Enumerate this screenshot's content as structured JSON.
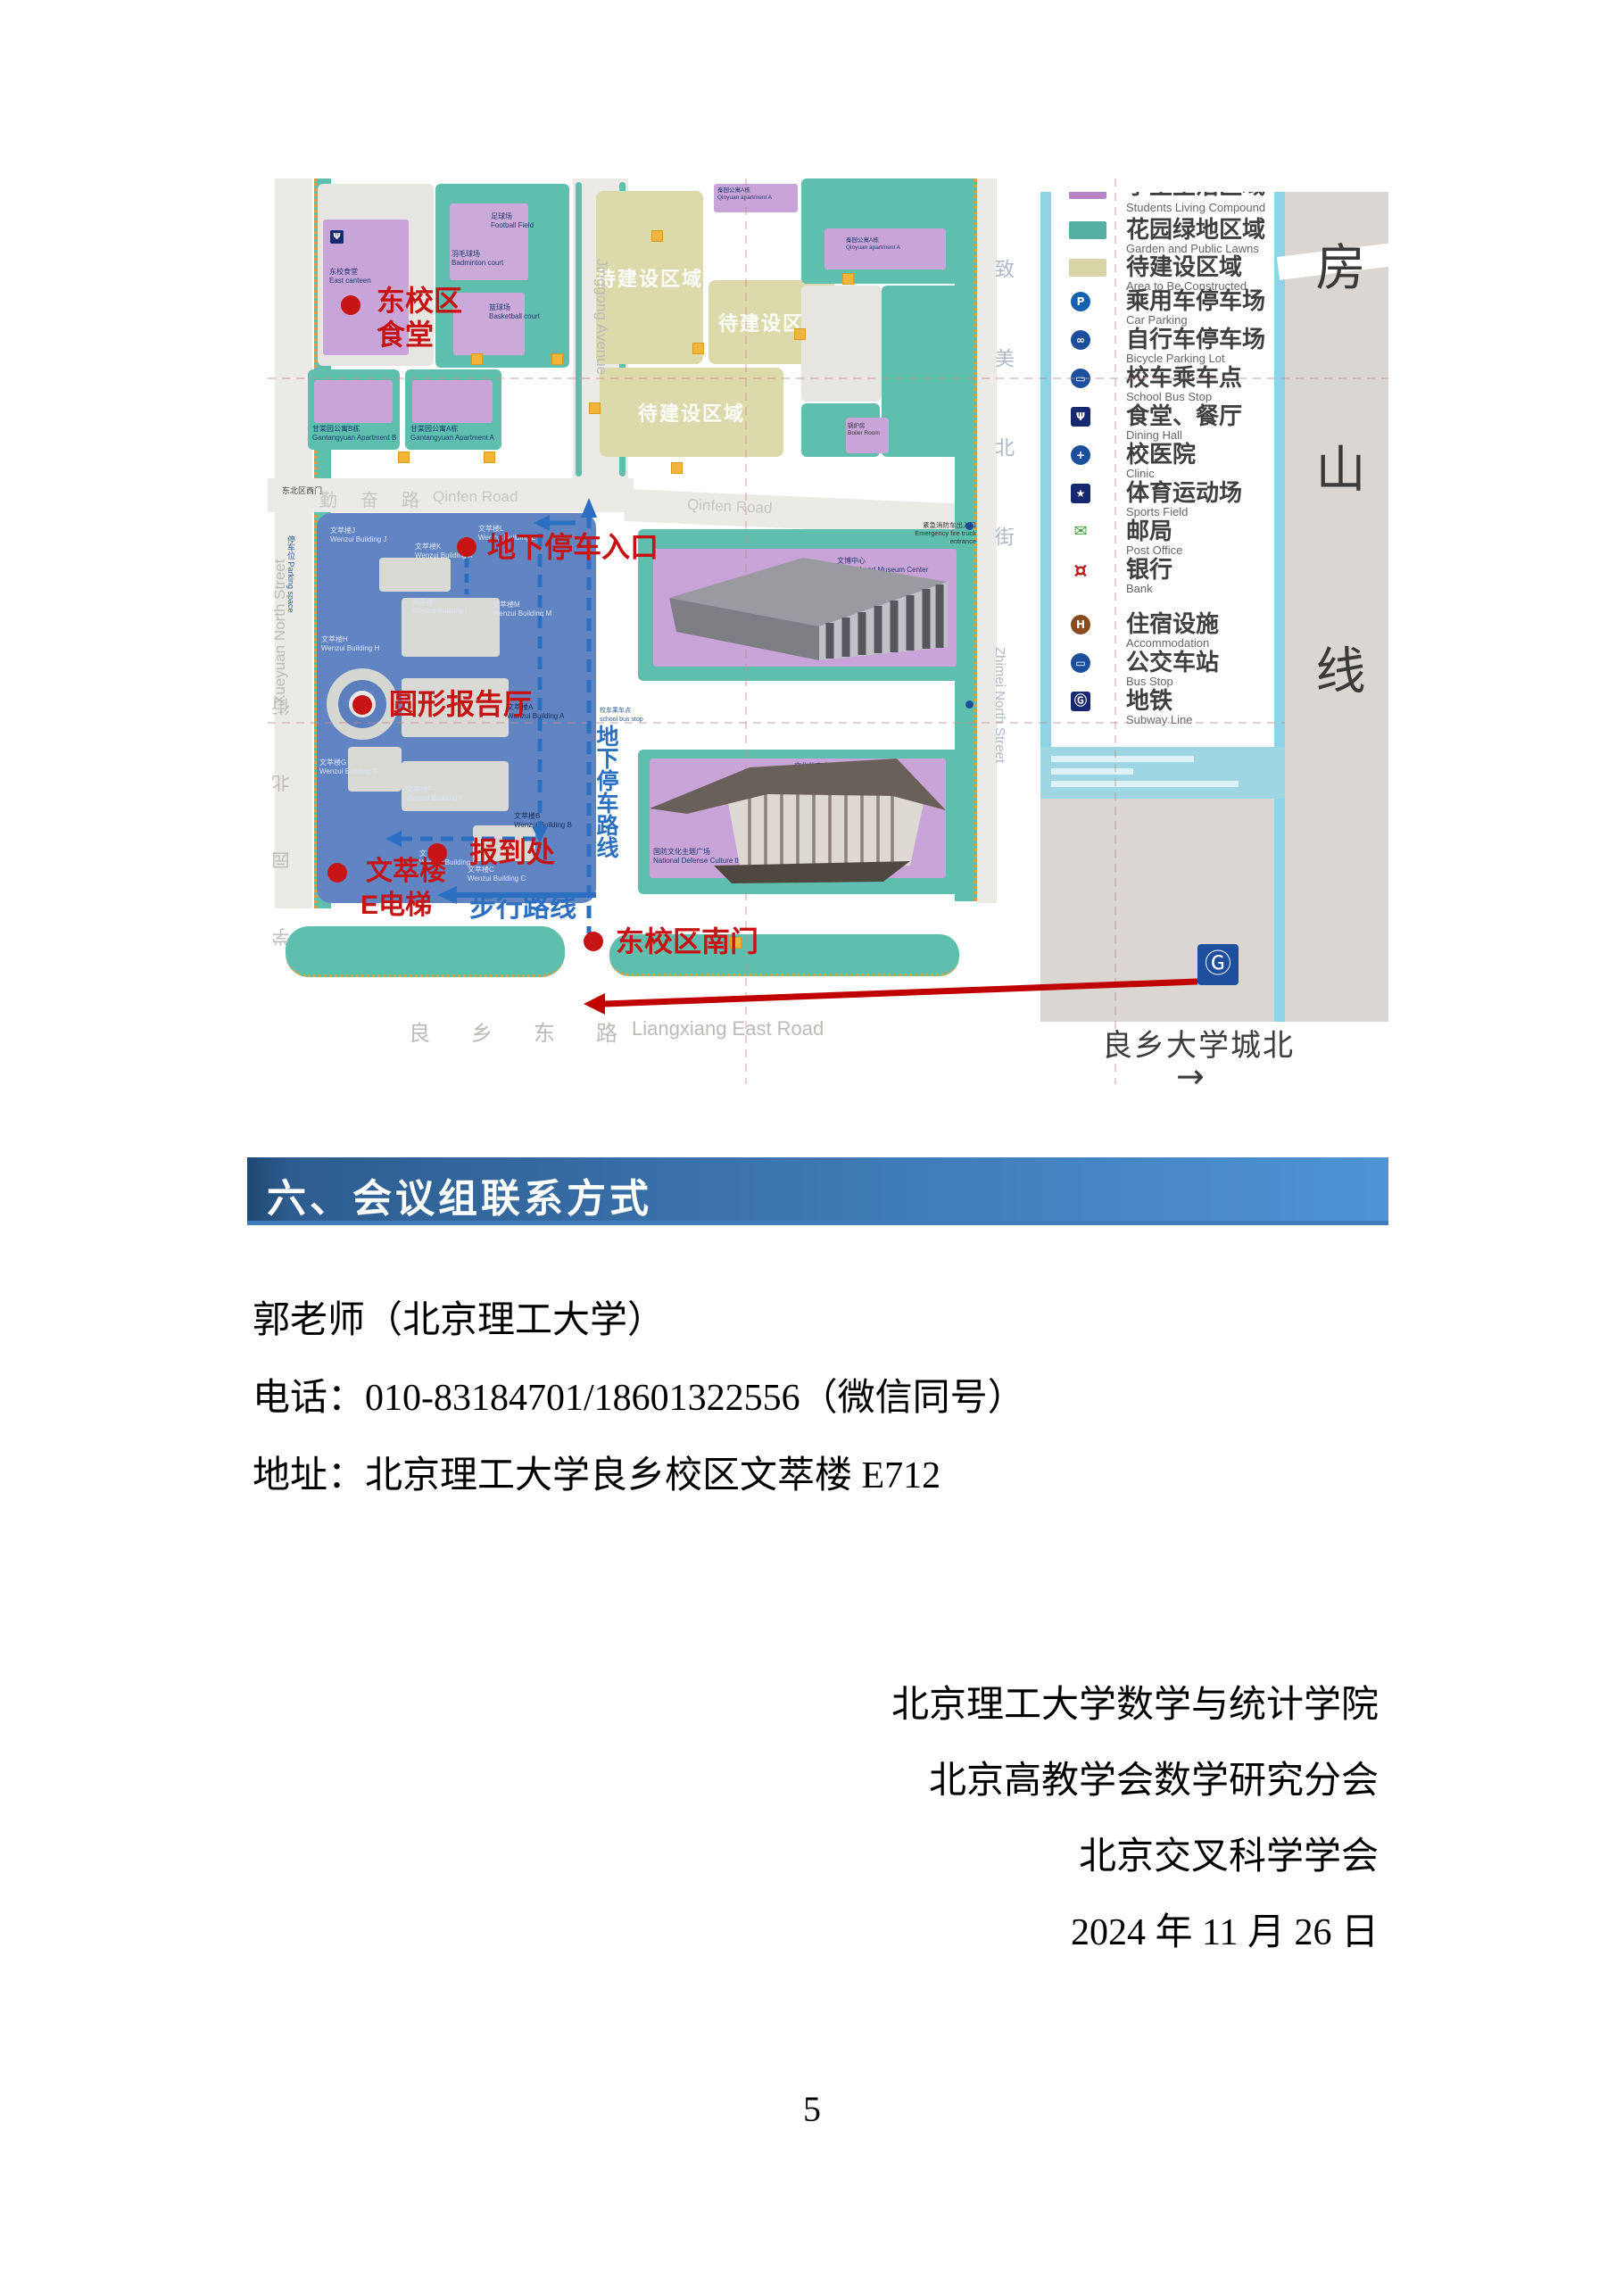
{
  "page": {
    "number": "5"
  },
  "colors": {
    "header_left": "#1f4870",
    "header_right": "#4e94d6",
    "annotation_red": "#c61414",
    "route_blue": "#2b6fc0",
    "garden_teal": "#5fbfae",
    "building_purple": "#c8a4d8",
    "to_build_beige": "#dcd9ab",
    "wenzui_blue": "#6184c2",
    "subway_line_blue": "#8fd4e6",
    "arrow_red": "#c00000"
  },
  "section": {
    "title": "六、会议组联系方式"
  },
  "contact": {
    "line1": "郭老师（北京理工大学）",
    "line2": "电话：010-83184701/18601322556（微信同号）",
    "line3": "地址：北京理工大学良乡校区文萃楼 E712"
  },
  "signature": {
    "line1": "北京理工大学数学与统计学院",
    "line2": "北京高教学会数学研究分会",
    "line3": "北京交叉科学学会",
    "line4": "2024 年 11 月 26 日"
  },
  "map": {
    "streets": {
      "qinfen_zh": "勤奋路",
      "qinfen_en": "Qinfen Road",
      "jinggong": "Jinggong Avenue",
      "xueyuan_en": "Xueyuan North Street",
      "xueyuan_zh": "学园北街",
      "zhimei_zh": "致美北街",
      "zhimei_en": "Zhimei North Street",
      "liangxiang_zh": "良乡东路",
      "liangxiang_en": "Liangxiang East Road",
      "fangshan": "房山线"
    },
    "labels": {
      "east_canteen": "东校食堂\nEast canteen",
      "football": "足球场\nFootball Field",
      "badminton": "羽毛球场\nBadminton court",
      "basketball": "篮球场\nBasketball court",
      "gantangyuan_b": "甘棠园公寓B栋\nGantangyuan Apartment B",
      "gantangyuan_a": "甘棠园公寓A栋\nGantangyuan Apartment A",
      "qinyuan_a": "秦园公寓A栋\nQinyuan apartment A",
      "boiler": "锅炉房\nBoiler Room",
      "to_be_built": "待建设区域",
      "museum": "文博中心\nCultural and Museum Center",
      "sports_center": "文化体育中心\nCulture and Sports Center",
      "defense_square": "国防文化主题广场\nNational Defense Culture theme Square",
      "school_bus": "校车乘车点\nschool bus stop",
      "fire_entrance": "紧急消防车出入口\nEmergency fire truck\nentrance",
      "northeast_gate": "东北区西门",
      "parking_space": "停车位 Parking space",
      "canteen_icon": "Ψ"
    },
    "wenzui": [
      "文萃楼J\nWenzui Building J",
      "文萃楼K\nWenzui Building K",
      "文萃楼L\nWenzui Building L",
      "文萃楼I\nWenzui Building I",
      "文萃楼M\nWenzui Building M",
      "文萃楼H\nWenzui Building H",
      "文萃楼A\nWenzui Building A",
      "文萃楼G\nWenzui Building G",
      "文萃楼F\nWenzui Building F",
      "文萃楼B\nWenzui Building B",
      "文萃楼D\nWenzui Building D",
      "文萃楼C\nWenzui Building C"
    ],
    "annotations": {
      "canteen_line1": "东校区",
      "canteen_line2": "食堂",
      "parking_entrance": "地下停车入口",
      "round_hall": "圆形报告厅",
      "checkin": "报到处",
      "wencui": "文萃楼",
      "elevator": "E电梯",
      "south_gate": "东校区南门",
      "walk_route": "步行路线",
      "parking_route": "地下停车路线"
    },
    "legend": {
      "items": [
        {
          "zh": "学生生活区域",
          "en": "Students Living Compound"
        },
        {
          "zh": "花园绿地区域",
          "en": "Garden and Public Lawns"
        },
        {
          "zh": "待建设区域",
          "en": "Area to Be Constructed"
        },
        {
          "zh": "乘用车停车场",
          "en": "Car Parking",
          "glyph": "P"
        },
        {
          "zh": "自行车停车场",
          "en": "Bicycle Parking Lot",
          "glyph": "∞"
        },
        {
          "zh": "校车乘车点",
          "en": "School Bus Stop",
          "glyph": "▭"
        },
        {
          "zh": "食堂、餐厅",
          "en": "Dining Hall",
          "glyph": "Ψ"
        },
        {
          "zh": "校医院",
          "en": "Clinic",
          "glyph": "+"
        },
        {
          "zh": "体育运动场",
          "en": "Sports Field",
          "glyph": "★"
        },
        {
          "zh": "邮局",
          "en": "Post Office",
          "glyph": "✉"
        },
        {
          "zh": "银行",
          "en": "Bank",
          "glyph": "¤"
        },
        {
          "zh": "住宿设施",
          "en": "Accommodation",
          "glyph": "H"
        },
        {
          "zh": "公交车站",
          "en": "Bus Stop",
          "glyph": "▭"
        },
        {
          "zh": "地铁",
          "en": "Subway Line",
          "glyph": "Ⓖ"
        }
      ]
    },
    "subway": {
      "station": "良乡大学城北",
      "arrow": "→",
      "logo": "Ⓖ"
    }
  }
}
